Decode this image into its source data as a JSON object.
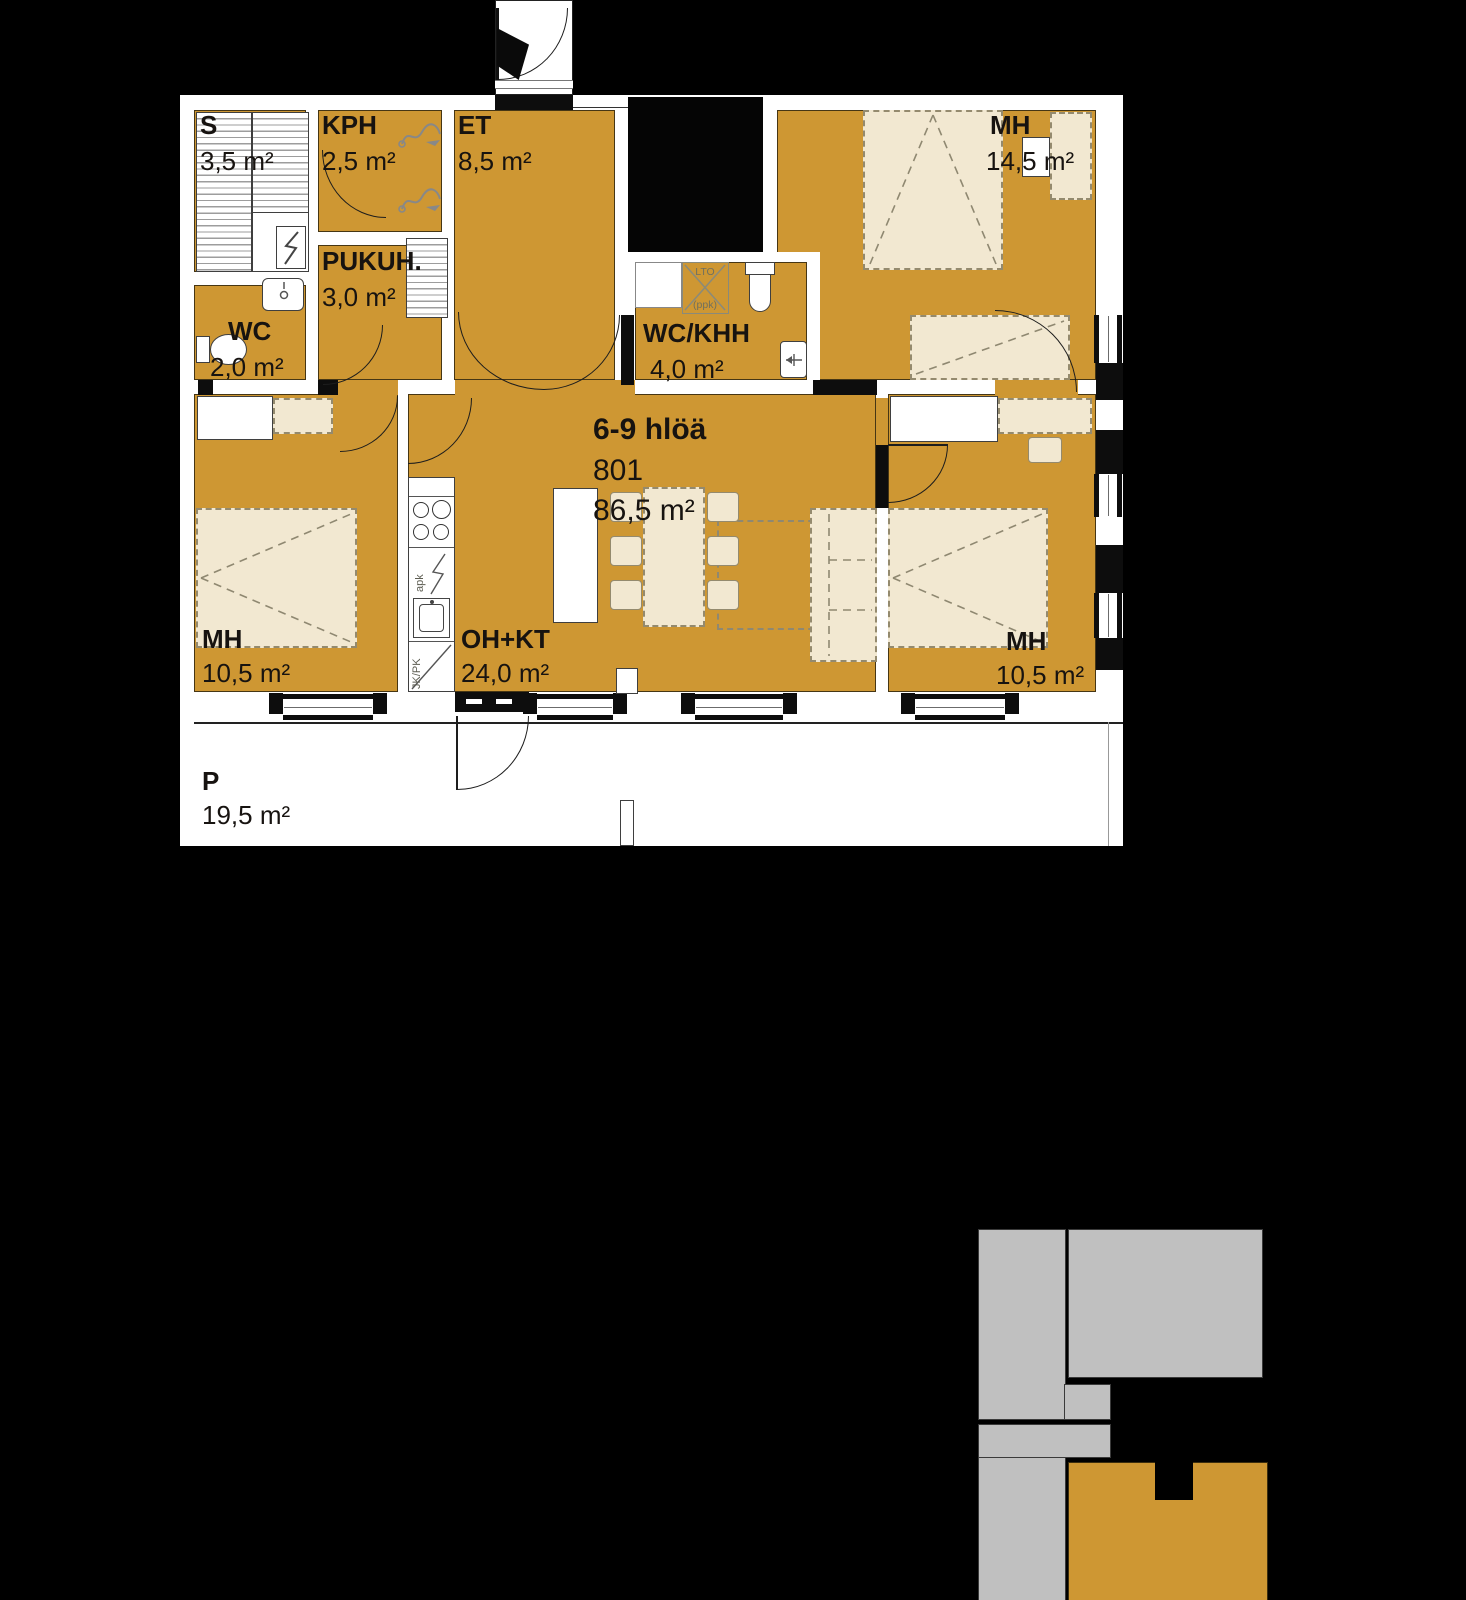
{
  "apartment": {
    "occupancy": "6-9 hlöä",
    "unit_number": "801",
    "total_area": "86,5 m²"
  },
  "rooms": {
    "sauna": {
      "name": "S",
      "area": "3,5 m²"
    },
    "bathroom": {
      "name": "KPH",
      "area": "2,5 m²"
    },
    "entry": {
      "name": "ET",
      "area": "8,5 m²"
    },
    "dressing": {
      "name": "PUKUH.",
      "area": "3,0 m²"
    },
    "wc": {
      "name": "WC",
      "area": "2,0 m²"
    },
    "wc_utility": {
      "name": "WC/KHH",
      "area": "4,0 m²"
    },
    "bedroom_1": {
      "name": "MH",
      "area": "14,5 m²"
    },
    "bedroom_2": {
      "name": "MH",
      "area": "10,5 m²"
    },
    "living_kitchen": {
      "name": "OH+KT",
      "area": "24,0 m²"
    },
    "bedroom_3": {
      "name": "MH",
      "area": "10,5 m²"
    },
    "terrace": {
      "name": "P",
      "area": "19,5 m²"
    }
  },
  "appliance_labels": {
    "heat_recovery_line1": "LTO",
    "heat_recovery_line2": "(ppk)",
    "dishwasher": "apk",
    "fridge_freezer": "JK/PK"
  },
  "colors": {
    "background": "#000000",
    "room_fill": "#CE9733",
    "wall": "#FFFFFF",
    "furniture_fill": "#F2E8D1",
    "minimap_building": "#C0C0C0",
    "minimap_highlight": "#CE9733"
  }
}
